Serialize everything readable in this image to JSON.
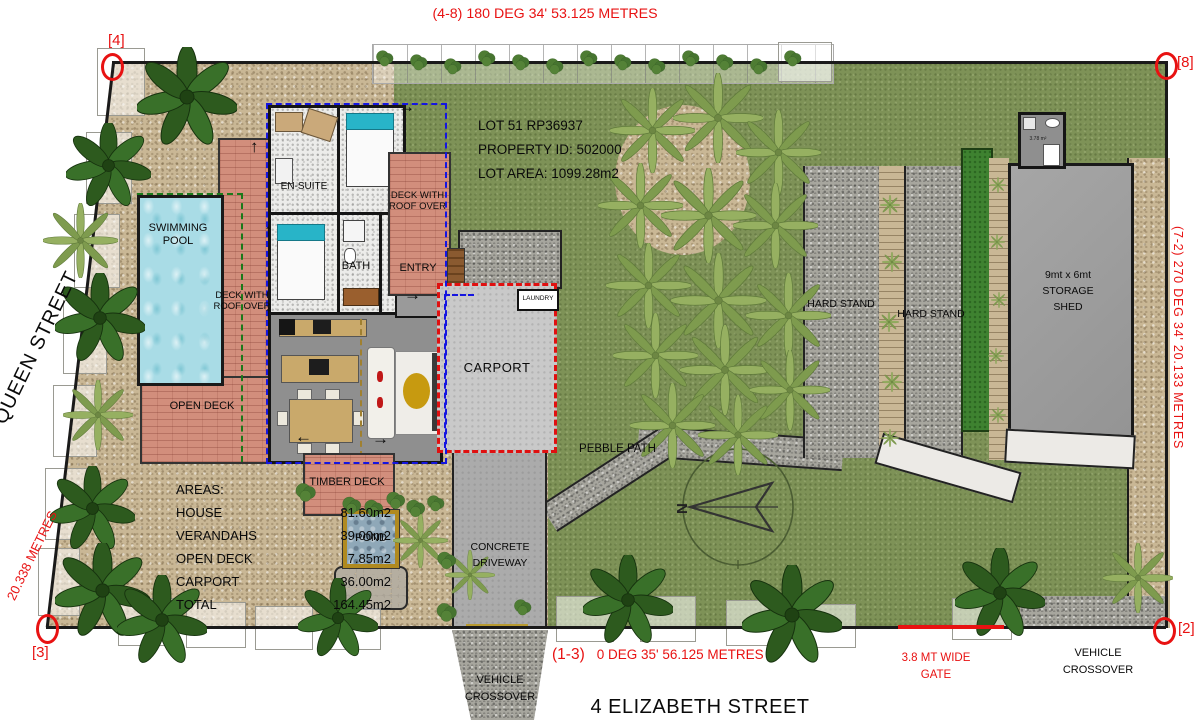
{
  "plan": {
    "streets": {
      "bottom": "4 ELIZABETH STREET",
      "left": "37 QUEEN STREET"
    },
    "boundaries": {
      "top": "(4-8)  180 DEG 34' 53.125 METRES",
      "bottom_prefix": "(1-3)",
      "bottom": "0 DEG 35'  56.125 METRES",
      "left": "20.338 METRES",
      "right": "(7-2) 270 DEG 34'  20.133 METRES"
    },
    "corner_markers": {
      "c4": "[4]",
      "c8": "[8]",
      "c2": "[2]",
      "c3": "[3]"
    },
    "lot_info": {
      "line1": "LOT 51 RP36937",
      "line2": "PROPERTY ID: 502000",
      "line3": "LOT AREA: 1099.28m2"
    },
    "areas": {
      "title": "AREAS:",
      "rows": [
        {
          "name": "HOUSE",
          "value": "81.60m2"
        },
        {
          "name": "VERANDAHS",
          "value": "39.00m2"
        },
        {
          "name": "OPEN DECK",
          "value": "7.85m2"
        },
        {
          "name": "CARPORT",
          "value": "36.00m2"
        },
        {
          "name": "TOTAL",
          "value": "164.45m2"
        }
      ]
    },
    "labels": {
      "swimming_pool": "SWIMMING POOL",
      "deck_roof_left": "DECK WITH ROOF OVER",
      "deck_roof_right": "DECK WITH ROOF OVER",
      "open_deck": "OPEN DECK",
      "en_suite": "EN-SUITE",
      "bath": "BATH",
      "entry": "ENTRY",
      "laundry": "LAUNDRY",
      "carport": "CARPORT",
      "timber_deck": "TIMBER DECK",
      "pond": "POND",
      "pebble_path": "PEBBLE PATH",
      "hard_stand_1": "HARD STAND",
      "hard_stand_2": "HARD STAND",
      "storage_shed": "9mt x 6mt STORAGE SHED",
      "shed_wc": "3.78 m²",
      "concrete_driveway": "CONCRETE DRIVEWAY",
      "vehicle_crossover_bottom": "VEHICLE CROSSOVER",
      "vehicle_crossover_right": "VEHICLE CROSSOVER",
      "gate": "3.8 MT WIDE GATE",
      "north": "N"
    },
    "colors": {
      "dimension_red": "#e81212",
      "lawn_green": "#7e9257",
      "pebble_tan": "#c9b795",
      "deck_pink": "#d28e7c",
      "pool_blue": "#a9dce6",
      "hardstand_grey": "#a7a69e",
      "green_strip": "#3e8230",
      "house_outline_blue": "#1515e0",
      "carport_outline_red": "#e01010",
      "pool_fence_green": "#1a7a1a"
    }
  }
}
